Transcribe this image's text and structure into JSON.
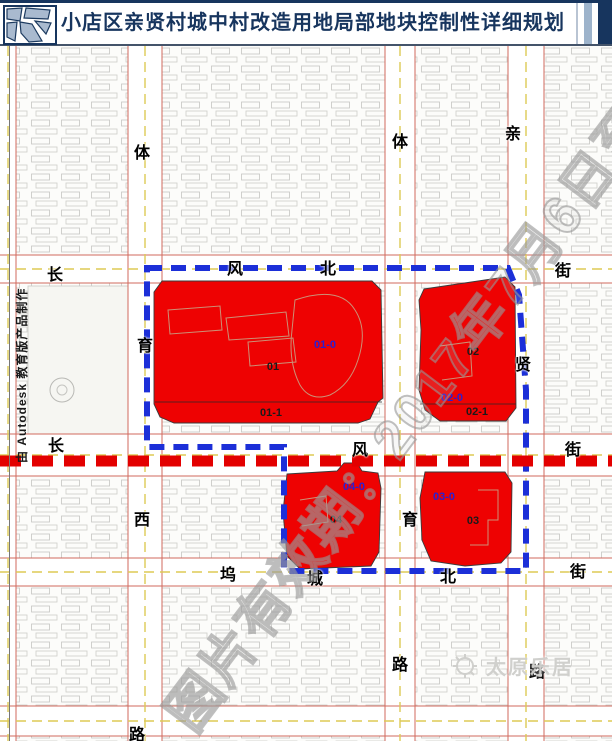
{
  "header": {
    "title": "小店区亲贤村城中村改造用地局部地块控制性详细规划"
  },
  "credits": {
    "autodesk_note": "由 Autodesk 教育版产品制作"
  },
  "watermarks": {
    "validity_text": "图片有效期：2017年7月6日至2017",
    "brand": "太原乐居"
  },
  "map": {
    "colors": {
      "plot_red": "#ee0202",
      "boundary_blue": "#1c2fd8",
      "planned_road_red": "#e30000",
      "plot_label_blue": "#2b1fd0",
      "title_navy": "#17355e"
    },
    "street_labels": [
      {
        "ch": "体",
        "x": 142,
        "y": 151
      },
      {
        "ch": "体",
        "x": 400,
        "y": 140
      },
      {
        "ch": "亲",
        "x": 513,
        "y": 132
      },
      {
        "ch": "长",
        "x": 55,
        "y": 273
      },
      {
        "ch": "风",
        "x": 235,
        "y": 267
      },
      {
        "ch": "北",
        "x": 328,
        "y": 267
      },
      {
        "ch": "街",
        "x": 563,
        "y": 269
      },
      {
        "ch": "育",
        "x": 145,
        "y": 344
      },
      {
        "ch": "贤",
        "x": 523,
        "y": 363
      },
      {
        "ch": "长",
        "x": 56,
        "y": 444
      },
      {
        "ch": "风",
        "x": 360,
        "y": 448
      },
      {
        "ch": "街",
        "x": 573,
        "y": 448
      },
      {
        "ch": "西",
        "x": 142,
        "y": 518
      },
      {
        "ch": "育",
        "x": 410,
        "y": 518
      },
      {
        "ch": "坞",
        "x": 228,
        "y": 573
      },
      {
        "ch": "城",
        "x": 315,
        "y": 577
      },
      {
        "ch": "北",
        "x": 448,
        "y": 575
      },
      {
        "ch": "街",
        "x": 578,
        "y": 570
      },
      {
        "ch": "路",
        "x": 400,
        "y": 663
      },
      {
        "ch": "路",
        "x": 537,
        "y": 670
      },
      {
        "ch": "路",
        "x": 137,
        "y": 733
      }
    ],
    "plot_labels": [
      {
        "text": "01-0",
        "x": 325,
        "y": 345,
        "type": "blue"
      },
      {
        "text": "01",
        "x": 273,
        "y": 367,
        "type": "black"
      },
      {
        "text": "01-1",
        "x": 271,
        "y": 413,
        "type": "black"
      },
      {
        "text": "02",
        "x": 473,
        "y": 352,
        "type": "black"
      },
      {
        "text": "02-0",
        "x": 452,
        "y": 398,
        "type": "blue"
      },
      {
        "text": "02-1",
        "x": 477,
        "y": 412,
        "type": "black"
      },
      {
        "text": "04-0",
        "x": 354,
        "y": 487,
        "type": "blue"
      },
      {
        "text": "04",
        "x": 336,
        "y": 520,
        "type": "black"
      },
      {
        "text": "03-0",
        "x": 444,
        "y": 497,
        "type": "blue"
      },
      {
        "text": "03",
        "x": 473,
        "y": 521,
        "type": "black"
      }
    ]
  }
}
